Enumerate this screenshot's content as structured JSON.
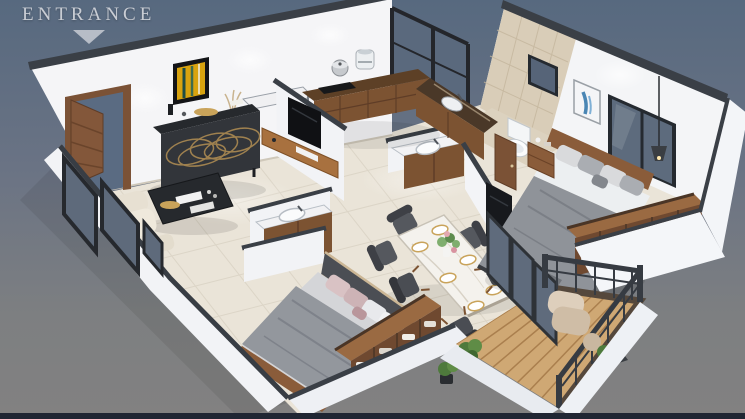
{
  "entrance": {
    "label": "ENTRANCE",
    "arrow": "down-triangle"
  },
  "footer_bar": {
    "present": true
  },
  "scene": {
    "type": "isometric-3d-floor-plan-render",
    "rooms": [
      {
        "id": "living-room",
        "furniture": [
          "sideboard-gold-pattern",
          "coffee-table",
          "cream-armchair",
          "tv-panel",
          "floating-tv-console",
          "yellow-wall-art",
          "entry-door-open"
        ]
      },
      {
        "id": "kitchen",
        "furniture": [
          "l-shaped-wood-counter",
          "white-counter-ledge",
          "cooking-pot",
          "air-fryer",
          "cooktop",
          "kitchen-sink",
          "tall-black-window"
        ]
      },
      {
        "id": "bathroom",
        "furniture": [
          "toilet",
          "vanity-with-sink",
          "tiled-wall",
          "tile-window",
          "wood-door"
        ]
      },
      {
        "id": "dining-area",
        "furniture": [
          "marble-dining-table",
          "six-dark-chairs",
          "place-settings",
          "flower-centerpiece",
          "washbasin-unit"
        ]
      },
      {
        "id": "master-bedroom",
        "furniture": [
          "double-bed-gray",
          "wood-headboard",
          "nightstand",
          "open-wardrobe",
          "tv-panel",
          "pendant-lamp",
          "blue-wall-art",
          "large-window"
        ]
      },
      {
        "id": "second-bedroom",
        "furniture": [
          "double-bed-pink-pillows",
          "upholstered-headboard",
          "open-wardrobe-with-clothes"
        ]
      },
      {
        "id": "balcony",
        "furniture": [
          "wood-deck",
          "metal-railing",
          "cream-armchair",
          "potted-plants",
          "folding-glass-door"
        ]
      }
    ]
  },
  "colors": {
    "background_top": "#57697f",
    "background_bottom": "#828181",
    "footer_bar": "#20263300",
    "footer_bar_hex": "#202633",
    "wall_white": "#f4f5f7",
    "wall_cap_dark": "#3a3f46",
    "floor_marble": "#eae4d8",
    "bath_tile": "#d9cdb8",
    "wood_dark": "#7c5332",
    "wood_light": "#a8713f",
    "glass_slate": "#5b6a7e",
    "artwork_yellow": "#d8a30f",
    "artwork_blue": "#4a86b4",
    "upholstery_gray": "#8f9399",
    "pillow_pink": "#d9c2c4",
    "plant_green": "#4e7a3c",
    "deck_wood": "#cfa874",
    "entrance_text": "#c9cdd4"
  }
}
